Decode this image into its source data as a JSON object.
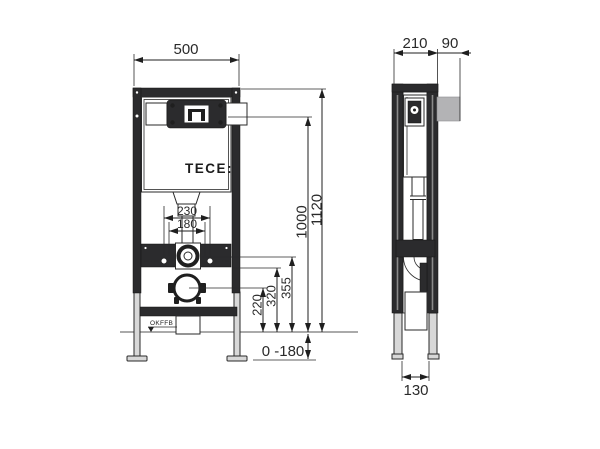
{
  "diagram": {
    "brand": {
      "logo_text": "TECE:"
    },
    "floor_marker_label": "OKFFB",
    "front_view": {
      "dims": {
        "width": "500",
        "total_height": "1120",
        "upper_height": "1000",
        "fixing_span_outer": "230",
        "fixing_span_inner": "180",
        "drain_center_height": "220",
        "connection_height": "320",
        "valve_height": "355",
        "leg_adjust_range": "0 -180"
      }
    },
    "side_view": {
      "dims": {
        "frame_depth": "210",
        "actuator_depth": "90",
        "foot_depth": "130"
      }
    },
    "colors": {
      "line": "#2a2a2a",
      "frame_fill": "#2b2b2d",
      "actuator_plate_fill": "#b3b3b5",
      "leg_fill": "#d8d8d8",
      "background": "#ffffff"
    }
  }
}
